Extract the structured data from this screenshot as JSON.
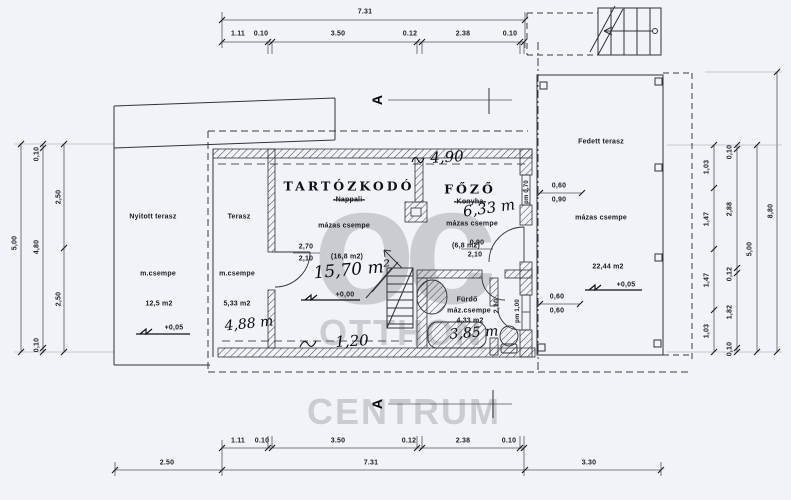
{
  "watermark": {
    "monogram": "oc",
    "line1": "OTTHON",
    "line2": "CENTRUM"
  },
  "rooms": {
    "nyitott_terasz": {
      "name": "Nyitott terasz",
      "finish": "m.csempe",
      "area": "12,5 m2",
      "level": "+0,05"
    },
    "terasz": {
      "name": "Terasz",
      "finish": "m.csempe",
      "area": "5,33 m2"
    },
    "tartozkodo": {
      "name": "TARTÓZKODÓ",
      "former_name": "-Nappali-",
      "finish": "mázas csempe",
      "area": "(16,8 m2)",
      "level": "+0,00"
    },
    "fozo": {
      "name": "FŐZŐ",
      "former_name": "-Konyha-",
      "finish": "mázas csempe",
      "area": "(6,8 m2)"
    },
    "furdo": {
      "name": "Fürdő",
      "finish": "máz.csempe",
      "area": "4,33 m2"
    },
    "fedett_terasz": {
      "name": "Fedett terasz",
      "finish": "mázas csempe",
      "area": "22,44 m2",
      "level": "+0,05"
    }
  },
  "handwritten": {
    "top_width": "4,90",
    "living_area": "15,70 m²",
    "kitchen_area": "6,33 m",
    "terasz_area": "4,88 m",
    "bottom_width": "1,20",
    "bath_area": "3,85 m"
  },
  "section_marker": "A",
  "dims": {
    "top": {
      "total": "7.31",
      "segments": [
        "1.11",
        "0.10",
        "3.50",
        "0.12",
        "2.38",
        "0.10"
      ]
    },
    "bottom": {
      "segments": [
        "1.11",
        "0.10",
        "3.50",
        "0.12",
        "2.38",
        "0.10"
      ],
      "totals": [
        "2.50",
        "7.31",
        "3.30"
      ]
    },
    "left": {
      "overall": "5,00",
      "chain": [
        "0,10",
        "4,80",
        "0,10"
      ],
      "halves": [
        "2,50",
        "2,50"
      ]
    },
    "right": {
      "chain_a": [
        "1,03",
        "1,47",
        "1,47",
        "1,03"
      ],
      "chain_b": [
        "0,10",
        "2,88",
        "0,12",
        "1,82",
        "0,10"
      ],
      "chain_c": "5,00",
      "chain_d": "8,80"
    },
    "openings": {
      "window_upper": [
        "0,60",
        "0,90"
      ],
      "window_lower": [
        "0,60",
        "0,60"
      ],
      "door_living": [
        "2,70",
        "2,10"
      ],
      "door_kitchen": [
        "0,90",
        "2,10"
      ],
      "door_bath": "2,10",
      "parapet_upper": "pm 0,70",
      "parapet_lower": "pm 1,00"
    }
  }
}
